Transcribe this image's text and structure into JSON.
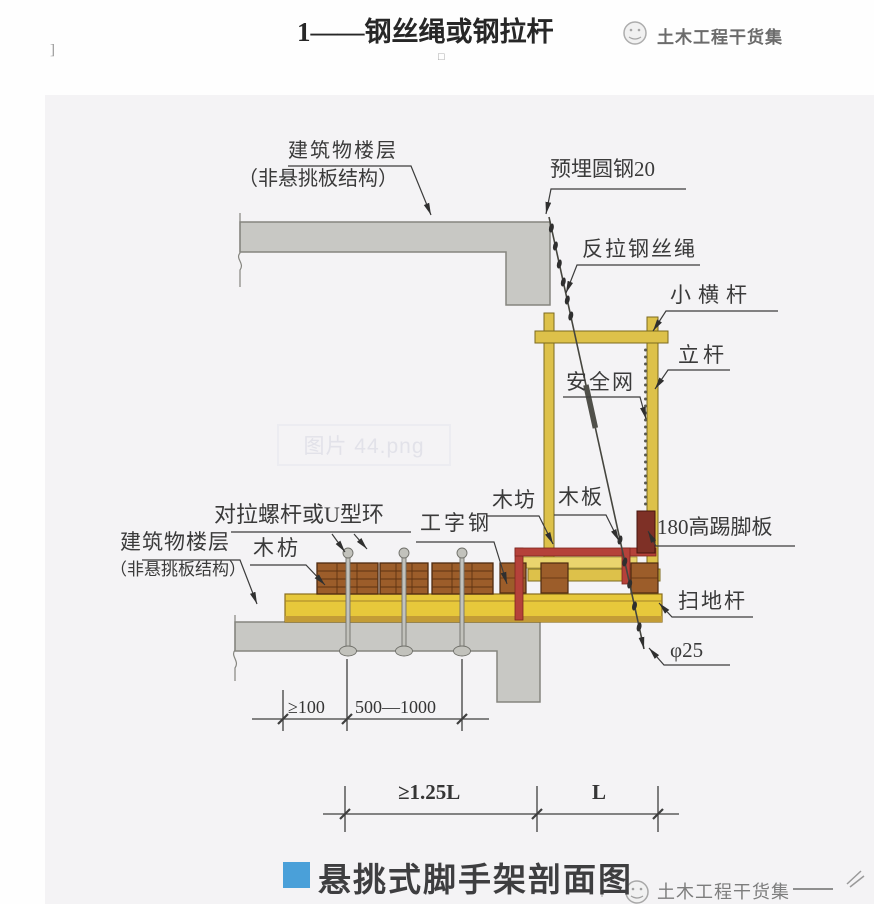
{
  "header": {
    "title": "1——钢丝绳或钢拉杆",
    "bracket_fragment": "]",
    "square_fragment": "□",
    "watermark": "土木工程干货集"
  },
  "diagram": {
    "file_watermark": "图片 44.png",
    "labels": {
      "floor_upper_1": "建筑物楼层",
      "floor_upper_2": "（非悬挑板结构）",
      "embedded_steel": "预埋圆钢20",
      "counter_rope": "反拉钢丝绳",
      "small_crossbar": "小横杆",
      "upright": "立杆",
      "safety_net": "安全网",
      "tie_bolt": "对拉螺杆或U型环",
      "wood_fang_left": "木枋",
      "i_beam": "工字钢",
      "wood_fang_right": "木坊",
      "wood_plank": "木板",
      "kickboard": "180高踢脚板",
      "floor_lower_1": "建筑物楼层",
      "floor_lower_2": "（非悬挑板结构）",
      "sweep_bar": "扫地杆",
      "phi25": "φ25"
    },
    "dimensions": {
      "offset_min": "≥100",
      "bolt_spacing": "500—1000",
      "anchor_span": "≥1.25L",
      "scaffold_span": "L"
    }
  },
  "footer": {
    "caption": "悬挑式脚手架剖面图",
    "watermark": "土木工程干货集"
  },
  "colors": {
    "caption_blue": "#4aa0d9",
    "slab_gray": "#c8c8c4",
    "frame_yellow": "#ddc14a",
    "beam_yellow": "#e7c83b",
    "frame_red": "#b5413a",
    "kickboard_maroon": "#7e3026",
    "wood_brown": "#9c5d2a"
  }
}
